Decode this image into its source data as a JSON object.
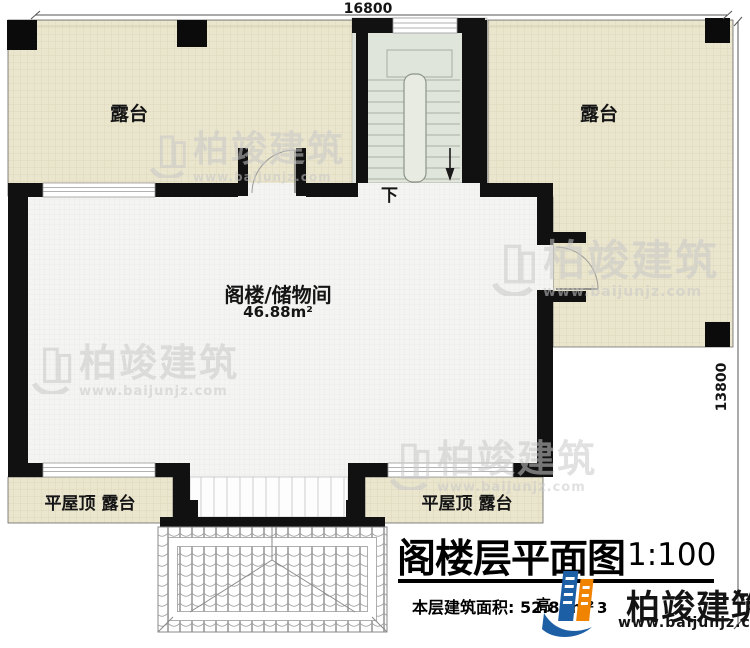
{
  "document": {
    "plan_title": "阁楼层平面图",
    "scale": "1:100",
    "area_note": "本层建筑面积: 52.88m²",
    "obscured": {
      "f1": "高",
      "f2": "3"
    }
  },
  "dimensions": {
    "top": "16800",
    "right": "13800"
  },
  "rooms": {
    "terrace_left": "露台",
    "terrace_right": "露台",
    "attic_name": "阁楼/储物间",
    "attic_area": "46.88m²",
    "flat_roof_left": "平屋顶 露台",
    "flat_roof_right": "平屋顶 露台",
    "stair_down": "下"
  },
  "brand": {
    "name": "柏竣建筑",
    "url": "www.baijunjz.com"
  },
  "colors": {
    "terrace_fill": "#eae5cd",
    "room_fill": "#f4f4f2",
    "stair_fill": "#e0e5dc",
    "wall": "#111111",
    "logo_blue": "#1d5fa5",
    "logo_orange": "#f08300",
    "watermark_gray": "#c9c9c9"
  }
}
